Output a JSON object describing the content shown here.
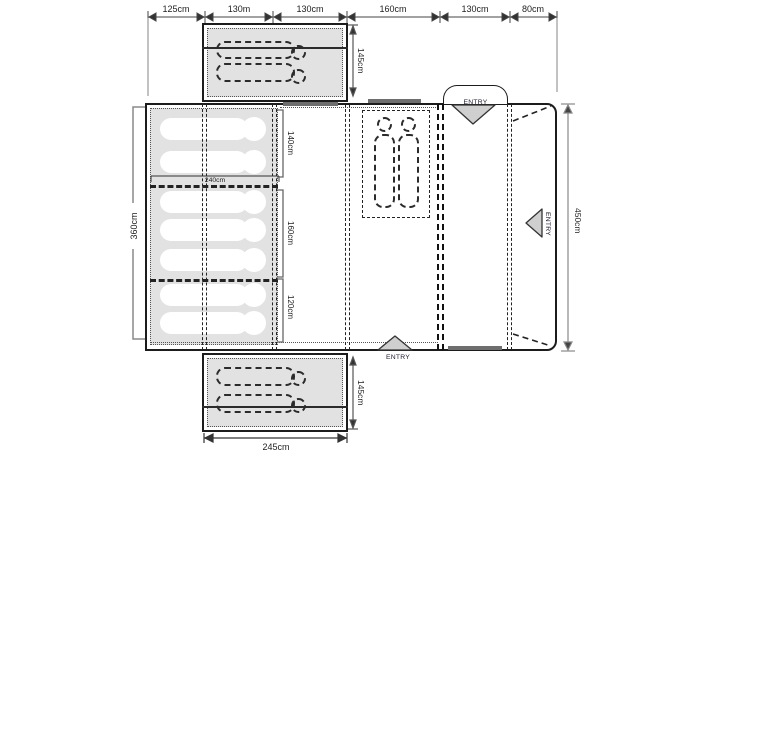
{
  "dimensions": {
    "top_row": [
      "125cm",
      "130m",
      "130cm",
      "160cm",
      "130cm",
      "80cm"
    ],
    "left_total": "360cm",
    "right_total": "450cm",
    "inner_width": "240cm",
    "bedrooms": [
      "140cm",
      "160cm",
      "120cm"
    ],
    "top_annex_depth": "145cm",
    "bottom_annex_depth": "145cm",
    "bottom_annex_width": "245cm"
  },
  "entries": {
    "top": "ENTRY",
    "right": "ENTRY",
    "bottom": "ENTRY"
  },
  "colors": {
    "outline": "#1c1c1c",
    "fill_gray": "#e2e2e2",
    "dim_line": "#808080",
    "entry_triangle_fill": "#cfcfcf",
    "door_sill": "#6e6e6e"
  }
}
